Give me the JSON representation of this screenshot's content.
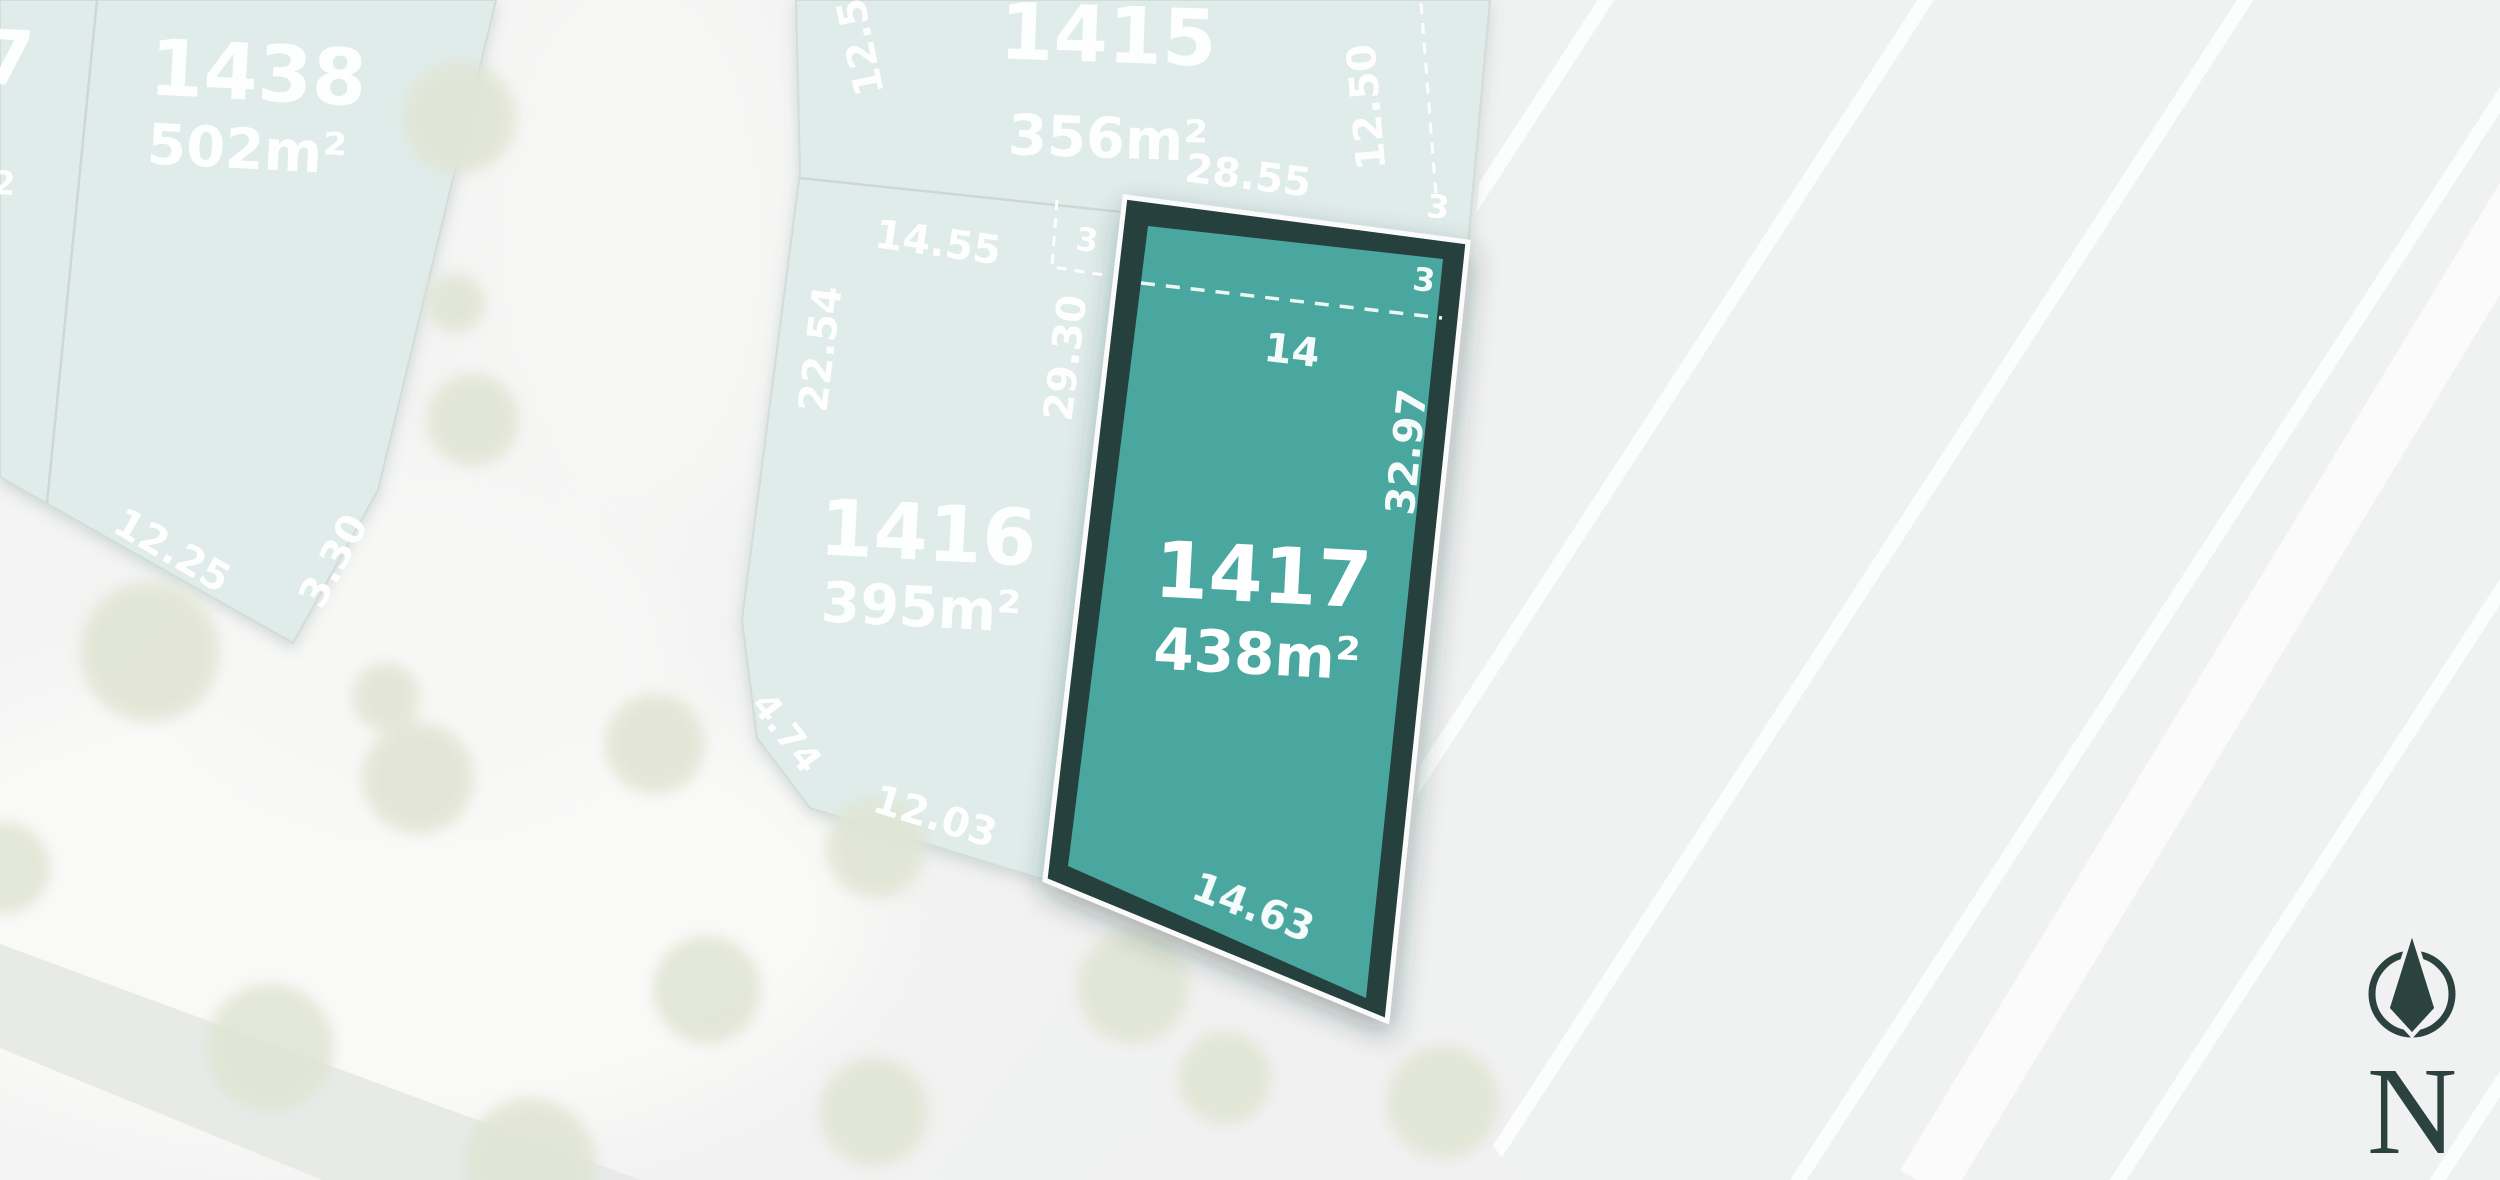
{
  "title": "Subdivision lot plan",
  "highlighted_lot": "1417",
  "lots": {
    "l7": {
      "number": "7",
      "area_superscript": "2"
    },
    "l1438": {
      "number": "1438",
      "area": "502m²"
    },
    "l1415": {
      "number": "1415",
      "area": "356m²"
    },
    "l1416": {
      "number": "1416",
      "area": "395m²"
    },
    "l1417": {
      "number": "1417",
      "area": "438m²"
    }
  },
  "measurements": {
    "lot1438": {
      "edge_sw": "12.25",
      "edge_se": "3.30"
    },
    "lot1415": {
      "side_left": "12.5",
      "side_right": "12.50",
      "bottom": "28.55"
    },
    "lot1416": {
      "top": "14.55",
      "side_left": "22.54",
      "side_right": "29.30",
      "corner_chamfer": "4.74",
      "bottom": "12.03",
      "offset_depth": "3"
    },
    "lot1417": {
      "offset_width": "14",
      "offset_depth_inner": "3",
      "offset_depth_outer": "3",
      "side_right": "32.97",
      "bottom": "14.63"
    }
  },
  "compass": {
    "north_label": "N"
  },
  "colors": {
    "highlight_fill": "#4AA7A0",
    "highlight_border": "#25403E",
    "lot_fill": "#DFECEA",
    "road_band": "#E8EAE8",
    "tree": "#E1E5D4",
    "tree_olive": "#B7B25F",
    "compass": "#2C423F",
    "background": "#F1F2F1"
  }
}
